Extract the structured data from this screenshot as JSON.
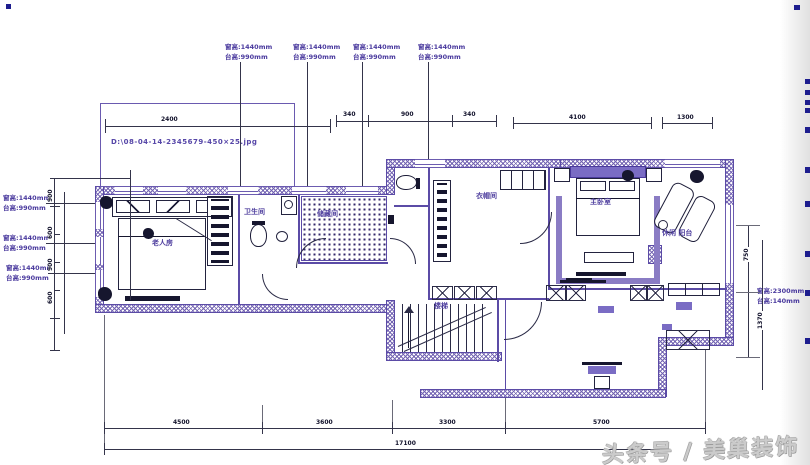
{
  "watermark": {
    "text": "头条号 / 美巢装饰"
  },
  "plan": {
    "rooms": {
      "bedroom2": "老人房",
      "bathroom": "卫生间",
      "storage": "储藏间",
      "closet": "衣帽间",
      "master_bedroom": "主卧室",
      "balcony": "休闲 阳台",
      "stairs": "楼梯"
    },
    "notes": {
      "image_path": "D:\\08-04-14-2345679-450×25.jpg"
    },
    "window_annotations": {
      "top": [
        {
          "l1": "窗高:1440mm",
          "l2": "台高:990mm"
        },
        {
          "l1": "窗高:1440mm",
          "l2": "台高:990mm"
        },
        {
          "l1": "窗高:1440mm",
          "l2": "台高:990mm"
        },
        {
          "l1": "窗高:1440mm",
          "l2": "台高:990mm"
        }
      ],
      "left": [
        {
          "l1": "窗高:1440mm",
          "l2": "台高:990mm"
        },
        {
          "l1": "窗高:1440mm",
          "l2": "台高:990mm"
        },
        {
          "l1": "窗高:1440mm",
          "l2": "台高:990mm"
        }
      ],
      "right": {
        "l1": "窗高:2300mm",
        "l2": "台高:140mm"
      }
    },
    "dimensions": {
      "top_left": "2400",
      "top_mid": [
        "340",
        "900",
        "340"
      ],
      "top_right": [
        "4100",
        "1300"
      ],
      "bottom_segments": [
        "4500",
        "3600",
        "3300",
        "5700"
      ],
      "bottom_total": "17100",
      "right": [
        "750",
        "1370"
      ],
      "left": [
        "900",
        "600",
        "900",
        "600"
      ]
    }
  },
  "colors": {
    "wall_purple": "#6f5fb0",
    "line_dark": "#1c1c38",
    "annotation_purple": "#4a3a9e",
    "watermark_gray": "#bcbcbc"
  }
}
